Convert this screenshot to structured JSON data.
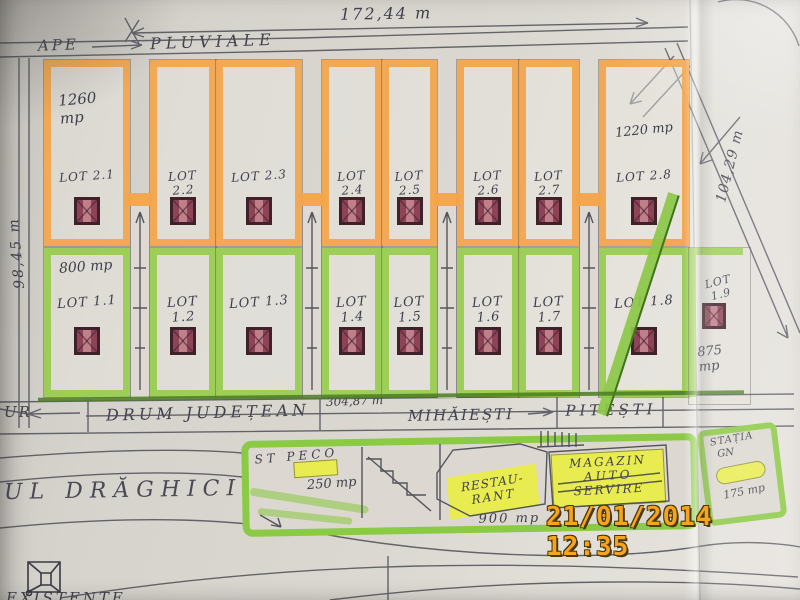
{
  "measurements": {
    "top_width": "172,44 m",
    "left_side": "98,45 m",
    "right_side": "104,29 m",
    "road_length": "304,87 m"
  },
  "drainage": {
    "ape": "APE",
    "pluviale": "PLUVIALE"
  },
  "lots_top": [
    {
      "label": "LOT 2.1",
      "area": "1260 mp"
    },
    {
      "label": "LOT 2.2"
    },
    {
      "label": "LOT 2.3"
    },
    {
      "label": "LOT 2.4"
    },
    {
      "label": "LOT 2.5"
    },
    {
      "label": "LOT 2.6"
    },
    {
      "label": "LOT 2.7"
    },
    {
      "label": "LOT 2.8",
      "area": "1220 mp"
    }
  ],
  "lots_bottom": [
    {
      "label": "LOT 1.1",
      "area": "800 mp"
    },
    {
      "label": "LOT 1.2"
    },
    {
      "label": "LOT 1.3"
    },
    {
      "label": "LOT 1.4"
    },
    {
      "label": "LOT 1.5"
    },
    {
      "label": "LOT 1.6"
    },
    {
      "label": "LOT 1.7"
    },
    {
      "label": "LOT 1.8"
    },
    {
      "label": "LOT 1.9",
      "area": "875 mp"
    }
  ],
  "road": {
    "fragment": "UR",
    "name": "DRUM JUDEȚEAN",
    "direction_1": "MIHĂIEȘTI",
    "direction_2": "PITEȘTI"
  },
  "river": {
    "name": "UL DRĂGHICI"
  },
  "commercial": {
    "gas_station": "ST PECO",
    "gas_station_area": "250 mp",
    "restaurant_line1": "RESTAU-",
    "restaurant_line2": "RANT",
    "shop_line1": "MAGAZIN",
    "shop_line2": "AUTO",
    "shop_line3": "SERVIRE",
    "shop_area": "900 mp",
    "bus_station_line1": "STAȚIA",
    "bus_station_line2": "GN",
    "bus_station_area": "175 mp"
  },
  "legend": {
    "existing": "EXISTENTE"
  },
  "camera": {
    "date": "21/01/2014",
    "time": "12:35"
  },
  "colors": {
    "orange_marker": "#f3a44a",
    "green_marker": "#97cc4d",
    "yellow_marker": "#e9ec50",
    "dark_red_symbol": "#8e4356",
    "timestamp": "#f6a41c"
  }
}
